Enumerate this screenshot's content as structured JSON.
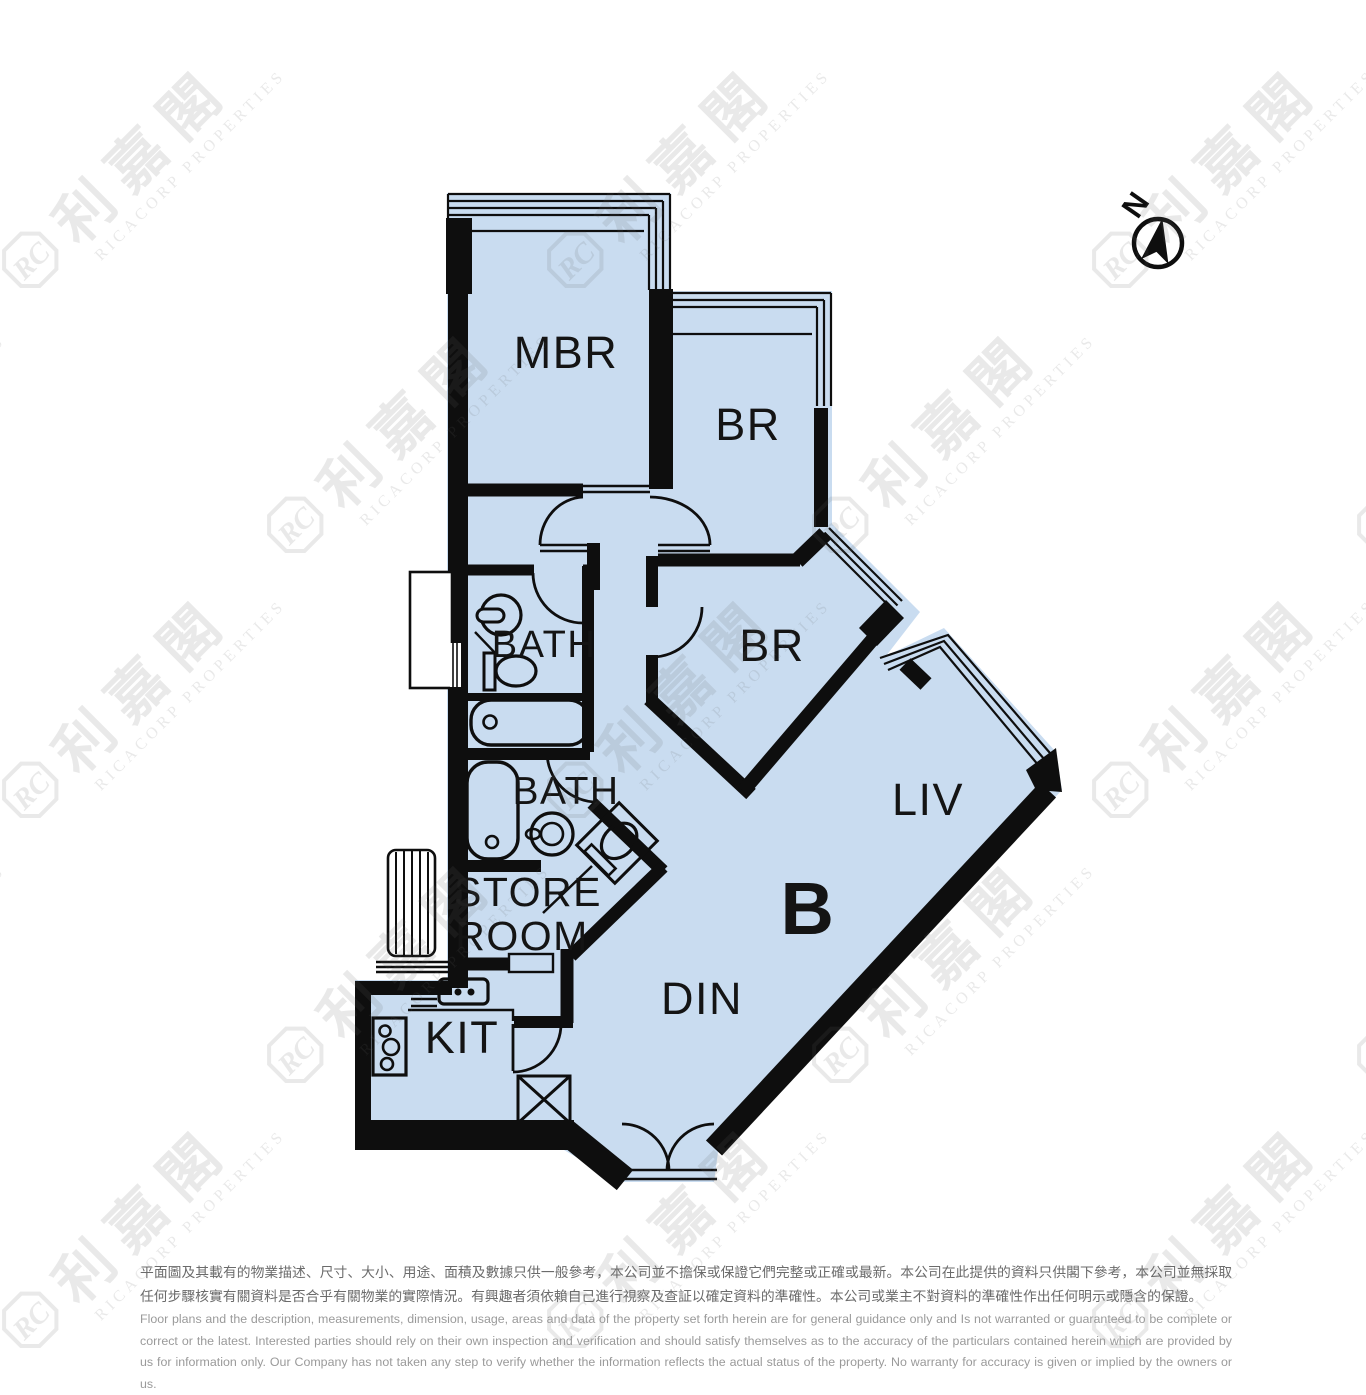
{
  "floor_plan": {
    "unit_label": "B",
    "fill_color": "#c9dcf0",
    "wall_color": "#0e0e0e",
    "rooms": {
      "mbr": "MBR",
      "br_top": "BR",
      "br_mid": "BR",
      "bath_upper": "BATH",
      "bath_lower": "BATH",
      "store_line1": "STORE",
      "store_line2": "ROOM",
      "kit": "KIT",
      "din": "DIN",
      "liv": "LIV"
    },
    "compass": {
      "label": "N"
    }
  },
  "watermark": {
    "logo_text": "RC",
    "cn": "利嘉閣",
    "en": "RICACORP PROPERTIES"
  },
  "disclaimer": {
    "cn": "平面圖及其載有的物業描述、尺寸、大小、用途、面積及數據只供一般參考，本公司並不擔保或保證它們完整或正確或最新。本公司在此提供的資料只供閣下參考，本公司並無採取任何步驟核實有關資料是否合乎有關物業的實際情況。有興趣者須依賴自己進行視察及查証以確定資料的準確性。本公司或業主不對資料的準確性作出任何明示或隱含的保證。",
    "en": "Floor plans and the description, measurements, dimension, usage, areas and data of the property set forth herein are for general guidance only and Is not warranted or guaranteed to be complete or correct or the latest. Interested parties should rely on their own inspection and verification and should satisfy themselves as to the accuracy of the particulars contained herein which are provided by us for information only.  Our Company has not taken any step to verify whether the information reflects the actual status of the property.  No warranty for accuracy is given or implied by the owners or us."
  }
}
